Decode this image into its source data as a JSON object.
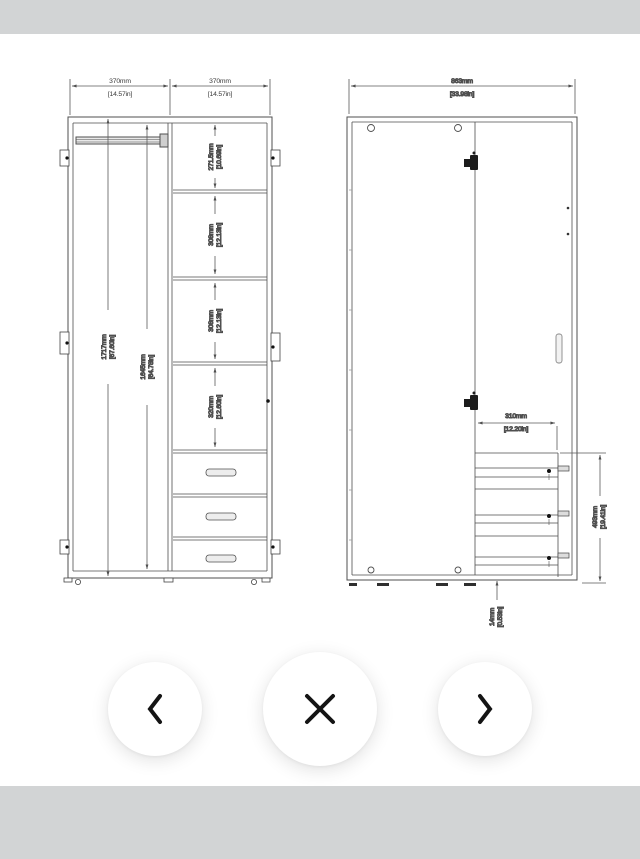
{
  "colors": {
    "band": "#d2d4d5",
    "line": "#4f4f4f",
    "dim": "#5a5a5a",
    "text": "#3a3a3a",
    "icon": "#141414",
    "btn_bg": "#ffffff"
  },
  "viewer": {
    "nav": [
      {
        "name": "previous image",
        "icon": "chevron-left"
      },
      {
        "name": "close viewer",
        "icon": "x-mark"
      },
      {
        "name": "next image",
        "icon": "chevron-right"
      }
    ]
  },
  "drawing": {
    "front_view": {
      "width_left": {
        "mm": "370mm",
        "in": "[14.57in]"
      },
      "width_right": {
        "mm": "370mm",
        "in": "[14.57in]"
      },
      "height_total": {
        "mm": "1717mm",
        "in": "[67.60in]"
      },
      "height_interior": {
        "mm": "1645mm",
        "in": "[64.78in]"
      },
      "shelf_1": {
        "mm": "271.5mm",
        "in": "[10.69in]"
      },
      "shelf_2": {
        "mm": "308mm",
        "in": "[12.13in]"
      },
      "shelf_3": {
        "mm": "308mm",
        "in": "[12.13in]"
      },
      "shelf_4": {
        "mm": "320mm",
        "in": "[12.60in]"
      }
    },
    "side_view": {
      "width_total": {
        "mm": "863mm",
        "in": "[33.98in]"
      },
      "drawer_width": {
        "mm": "310mm",
        "in": "[12.20in]"
      },
      "drawer_stack_height": {
        "mm": "493mm",
        "in": "[19.41in]"
      },
      "base_thickness": {
        "mm": "14mm",
        "in": "[0.53in]"
      }
    }
  }
}
